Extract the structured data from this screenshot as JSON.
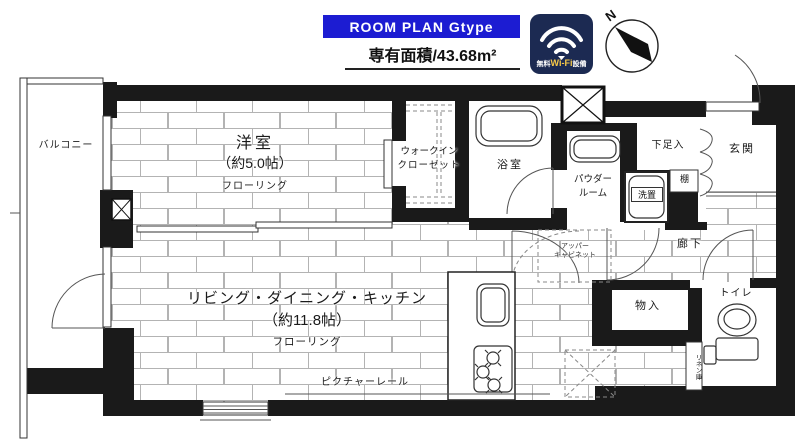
{
  "header": {
    "banner_title": "ROOM PLAN Gtype",
    "area_label": "専有面積/43.68m²",
    "wifi": {
      "prefix": "無料",
      "brand": "Wi-Fi",
      "suffix": "設備"
    },
    "compass": "N"
  },
  "colors": {
    "banner_bg": "#1c1cd2",
    "wifi_bg": "#1c2a52",
    "wifi_accent": "#f7c948",
    "wall": "#1a1a1a"
  },
  "rooms": {
    "balcony": "バルコニー",
    "western": {
      "name": "洋室",
      "size": "（約5.0帖）",
      "floor": "フローリング"
    },
    "wic": {
      "line1": "ウォークイン",
      "line2": "クローゼット"
    },
    "bathroom": "浴室",
    "powder": {
      "line1": "パウダー",
      "line2": "ルーム"
    },
    "washer": "洗置",
    "shoe_cabinet": "下足入",
    "shelf": "棚",
    "entrance": "玄関",
    "corridor": "廊下",
    "storage": "物入",
    "toilet": "トイレ",
    "linen": "リネン庫",
    "upper_cabinet": {
      "line1": "アッパー",
      "line2": "キャビネット"
    },
    "ldk": {
      "name": "リビング・ダイニング・キッチン",
      "size": "（約11.8帖）",
      "floor": "フローリング",
      "picture_rail": "ピクチャーレール"
    }
  }
}
